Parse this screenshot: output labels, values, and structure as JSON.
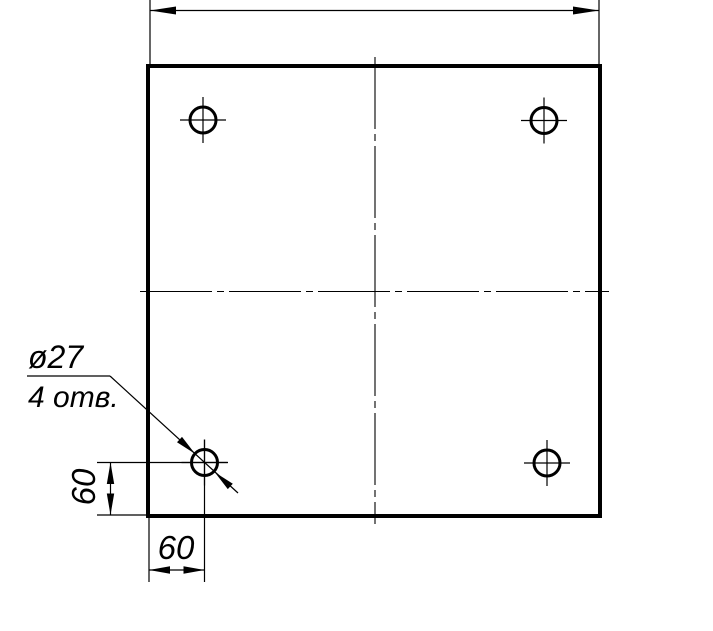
{
  "drawing": {
    "background_color": "#ffffff",
    "line_color": "#000000",
    "callout": {
      "diameter_label": "ø27",
      "count_label": "4 отв."
    },
    "dimensions": {
      "vertical_offset": "60",
      "horizontal_offset": "60"
    },
    "holes": {
      "count": 4,
      "diameter_value": 27,
      "radius_px": 13,
      "crosshair_extent_px": 23,
      "centers": [
        [
          203,
          120
        ],
        [
          544,
          120.5
        ],
        [
          204.5,
          462.5
        ],
        [
          547,
          463
        ]
      ]
    }
  }
}
